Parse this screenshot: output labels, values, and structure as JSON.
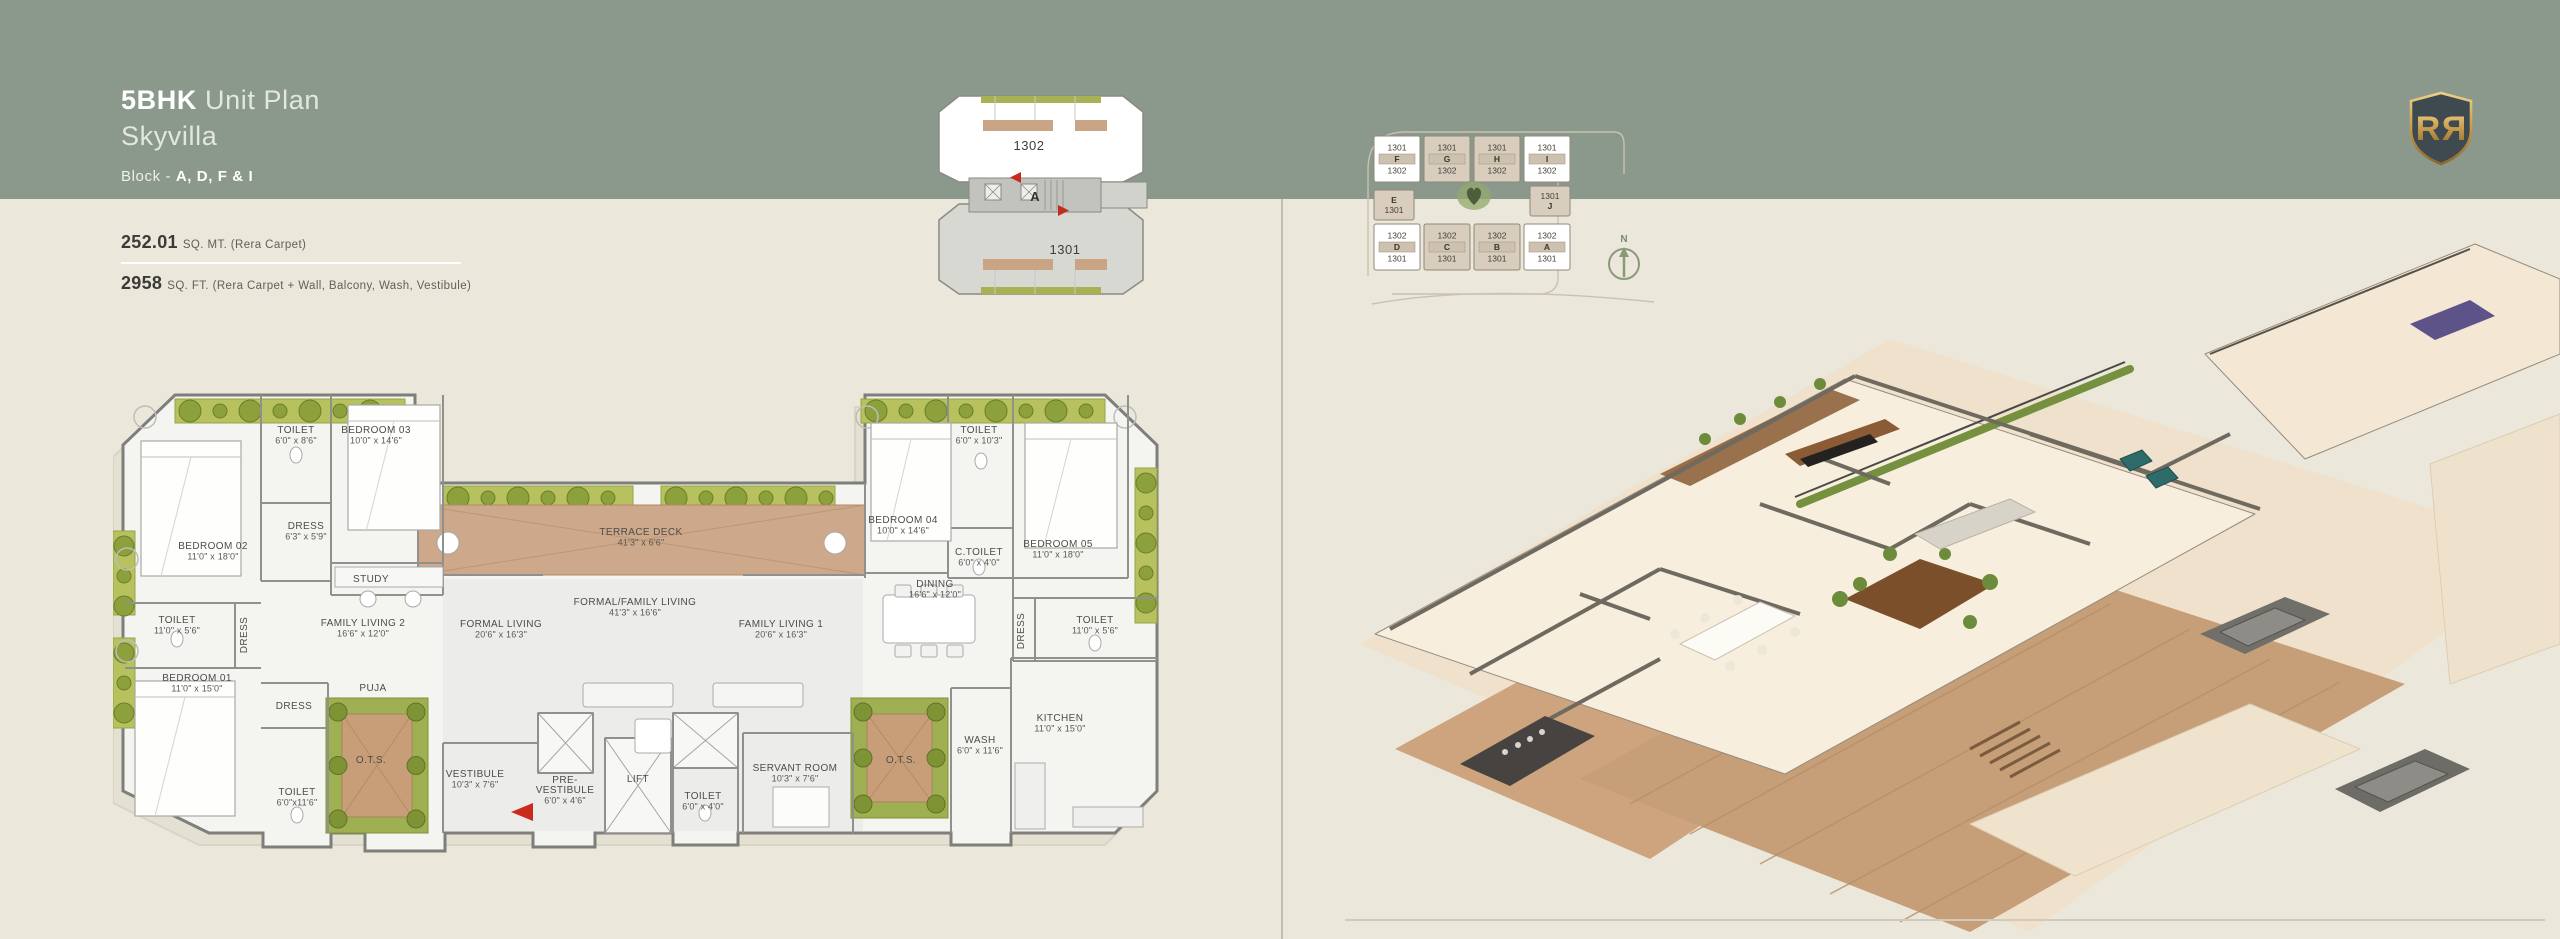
{
  "page": {
    "bg": "#EBE8DB",
    "band_color": "#8B988C",
    "divider_color": "#C2BFAF",
    "accent_red": "#C9291B"
  },
  "header": {
    "title_bold": "5BHK",
    "title_rest": " Unit Plan",
    "subtitle": "Skyvilla",
    "block_prefix": "Block - ",
    "block_value": "A, D, F & I"
  },
  "area": {
    "sqmt_value": "252.01",
    "sqmt_label": "SQ. MT. (Rera Carpet)",
    "sqft_value": "2958",
    "sqft_label": "SQ. FT. (Rera Carpet + Wall, Balcony, Wash, Vestibule)"
  },
  "key_plan": {
    "upper_unit": "1302",
    "lower_unit": "1301",
    "block_letter": "A"
  },
  "site_plan": {
    "north_label": "N",
    "blocks": [
      {
        "x": 12,
        "y": 10,
        "w": 46,
        "h": 46,
        "hl": true,
        "lines": [
          "1301",
          "F",
          "1302"
        ]
      },
      {
        "x": 62,
        "y": 10,
        "w": 46,
        "h": 46,
        "hl": false,
        "lines": [
          "1301",
          "G",
          "1302"
        ]
      },
      {
        "x": 112,
        "y": 10,
        "w": 46,
        "h": 46,
        "hl": false,
        "lines": [
          "1301",
          "H",
          "1302"
        ]
      },
      {
        "x": 162,
        "y": 10,
        "w": 46,
        "h": 46,
        "hl": true,
        "lines": [
          "1301",
          "I",
          "1302"
        ]
      },
      {
        "x": 12,
        "y": 64,
        "w": 40,
        "h": 30,
        "hl": false,
        "lines": [
          "E",
          "1301"
        ]
      },
      {
        "x": 168,
        "y": 60,
        "w": 40,
        "h": 30,
        "hl": false,
        "lines": [
          "1301",
          "J"
        ]
      },
      {
        "x": 12,
        "y": 98,
        "w": 46,
        "h": 46,
        "hl": true,
        "lines": [
          "1302",
          "D",
          "1301"
        ]
      },
      {
        "x": 62,
        "y": 98,
        "w": 46,
        "h": 46,
        "hl": false,
        "lines": [
          "1302",
          "C",
          "1301"
        ]
      },
      {
        "x": 112,
        "y": 98,
        "w": 46,
        "h": 46,
        "hl": false,
        "lines": [
          "1302",
          "B",
          "1301"
        ]
      },
      {
        "x": 162,
        "y": 98,
        "w": 46,
        "h": 46,
        "hl": true,
        "lines": [
          "1302",
          "A",
          "1301"
        ]
      }
    ]
  },
  "floor_plan": {
    "rooms": [
      {
        "n": [
          "TOILET"
        ],
        "d": "6'0\" x 8'6\"",
        "x": 183,
        "y": 50
      },
      {
        "n": [
          "BEDROOM 03"
        ],
        "d": "10'0\" x 14'6\"",
        "x": 263,
        "y": 50
      },
      {
        "n": [
          "DRESS"
        ],
        "d": "6'3\" x 5'9\"",
        "x": 193,
        "y": 146
      },
      {
        "n": [
          "BEDROOM 02"
        ],
        "d": "11'0\" x 18'0\"",
        "x": 100,
        "y": 166
      },
      {
        "n": [
          "STUDY"
        ],
        "x": 258,
        "y": 199
      },
      {
        "n": [
          "TOILET"
        ],
        "d": "11'0\" x 5'6\"",
        "x": 64,
        "y": 240
      },
      {
        "n": [
          "DRESS"
        ],
        "x": 134,
        "y": 252,
        "rot": -90
      },
      {
        "n": [
          "FAMILY LIVING 2"
        ],
        "d": "16'6\" x 12'0\"",
        "x": 250,
        "y": 243
      },
      {
        "n": [
          "BEDROOM 01"
        ],
        "d": "11'0\" x 15'0\"",
        "x": 84,
        "y": 298
      },
      {
        "n": [
          "PUJA"
        ],
        "x": 260,
        "y": 308
      },
      {
        "n": [
          "DRESS"
        ],
        "x": 181,
        "y": 326
      },
      {
        "n": [
          "O.T.S."
        ],
        "x": 258,
        "y": 380
      },
      {
        "n": [
          "TOILET"
        ],
        "d": "6'0\"x11'6\"",
        "x": 184,
        "y": 412
      },
      {
        "n": [
          "FORMAL LIVING"
        ],
        "d": "20'6\" x 16'3\"",
        "x": 388,
        "y": 244
      },
      {
        "n": [
          "TERRACE DECK"
        ],
        "d": "41'3\" x 6'6\"",
        "x": 528,
        "y": 152
      },
      {
        "n": [
          "FORMAL/FAMILY LIVING"
        ],
        "d": "41'3\" x 16'6\"",
        "x": 522,
        "y": 222
      },
      {
        "n": [
          "FAMILY LIVING 1"
        ],
        "d": "20'6\" x 16'3\"",
        "x": 668,
        "y": 244
      },
      {
        "n": [
          "VESTIBULE"
        ],
        "d": "10'3\" x 7'6\"",
        "x": 362,
        "y": 394
      },
      {
        "n": [
          "PRE-",
          "VESTIBULE"
        ],
        "d": "6'0\" x 4'6\"",
        "x": 452,
        "y": 400
      },
      {
        "n": [
          "LIFT"
        ],
        "x": 525,
        "y": 399
      },
      {
        "n": [
          "TOILET"
        ],
        "d": "6'0\" x 4'0\"",
        "x": 590,
        "y": 416
      },
      {
        "n": [
          "SERVANT ROOM"
        ],
        "d": "10'3\" x 7'6\"",
        "x": 682,
        "y": 388
      },
      {
        "n": [
          "O.T.S."
        ],
        "x": 788,
        "y": 380
      },
      {
        "n": [
          "WASH"
        ],
        "d": "6'0\" x 11'6\"",
        "x": 867,
        "y": 360
      },
      {
        "n": [
          "KITCHEN"
        ],
        "d": "11'0\" x 15'0\"",
        "x": 947,
        "y": 338
      },
      {
        "n": [
          "BEDROOM 04"
        ],
        "d": "10'0\" x 14'6\"",
        "x": 790,
        "y": 140
      },
      {
        "n": [
          "TOILET"
        ],
        "d": "6'0\" x 10'3\"",
        "x": 866,
        "y": 50
      },
      {
        "n": [
          "C.TOILET"
        ],
        "d": "6'0\" x 4'0\"",
        "x": 866,
        "y": 172
      },
      {
        "n": [
          "BEDROOM 05"
        ],
        "d": "11'0\" x 18'0\"",
        "x": 945,
        "y": 164
      },
      {
        "n": [
          "DINING"
        ],
        "d": "16'6\" x 12'0\"",
        "x": 822,
        "y": 204
      },
      {
        "n": [
          "DRESS"
        ],
        "x": 911,
        "y": 248,
        "rot": -90
      },
      {
        "n": [
          "TOILET"
        ],
        "d": "11'0\" x 5'6\"",
        "x": 982,
        "y": 240
      }
    ]
  },
  "logo": {
    "letter": "R"
  }
}
